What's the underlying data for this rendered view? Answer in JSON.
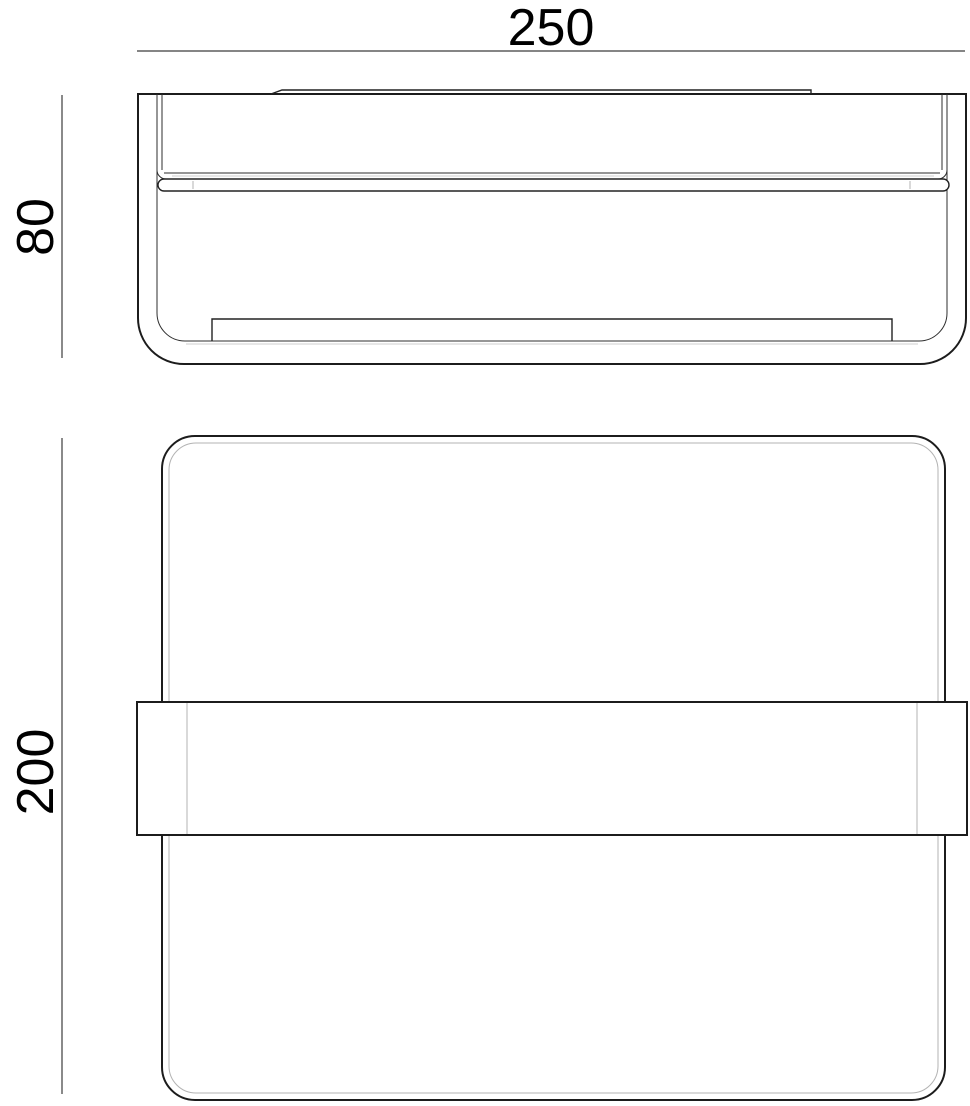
{
  "drawing": {
    "kind": "technical-dimension-drawing",
    "colors": {
      "line": "#1c1c1c",
      "medium_line": "#222222",
      "thin_line": "#2e2e2e",
      "light_line": "#b3b3b3",
      "dimension_line": "#3c3c3c",
      "text": "#000000",
      "background": "#ffffff"
    },
    "dimensions": {
      "width": {
        "value": "250",
        "orientation": "horizontal",
        "applies_to": "front-view-width"
      },
      "height": {
        "value": "80",
        "orientation": "vertical",
        "applies_to": "front-view-height"
      },
      "depth": {
        "value": "200",
        "orientation": "vertical",
        "applies_to": "plan-view-height"
      }
    }
  }
}
